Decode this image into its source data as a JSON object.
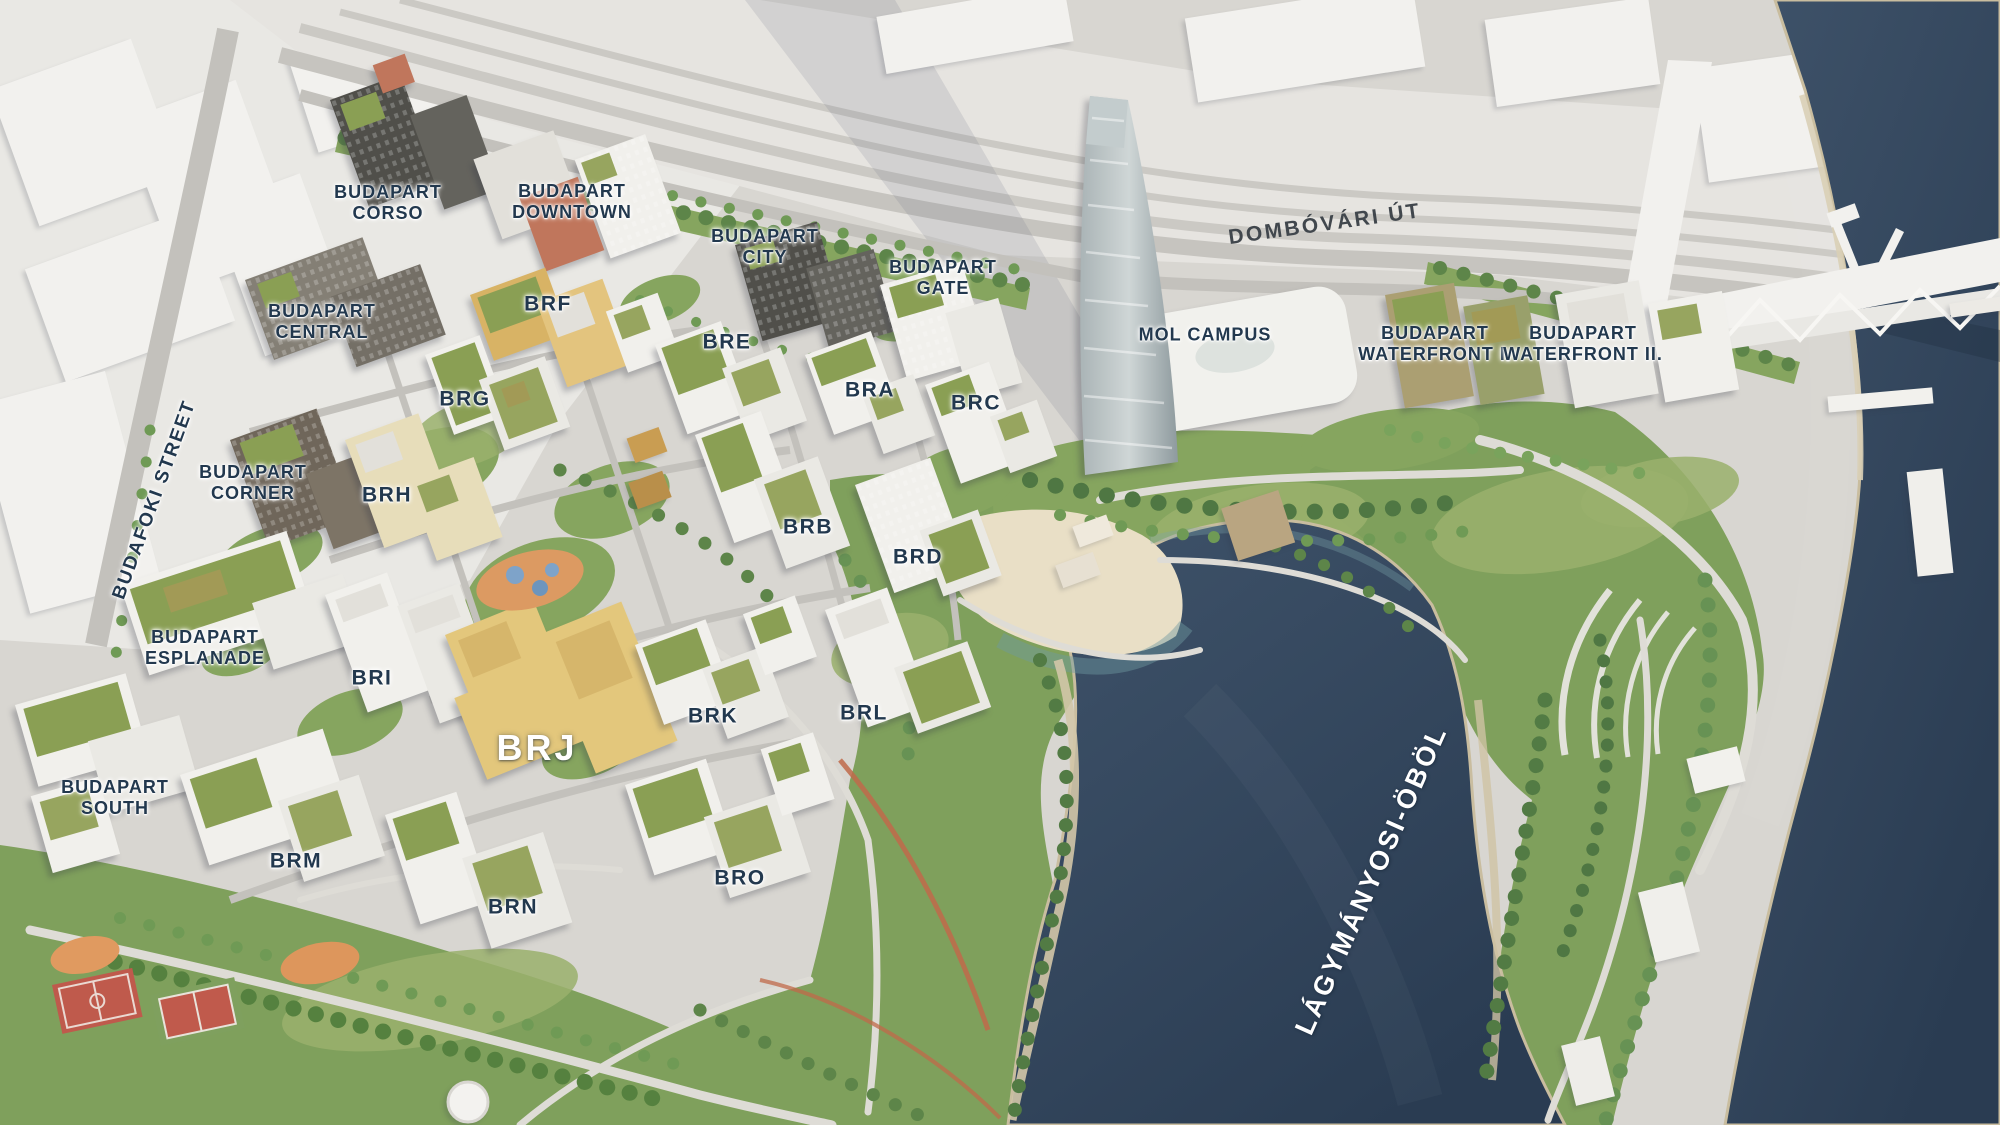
{
  "colors": {
    "water_light": "#3f536a",
    "water_dark": "#2a3c52",
    "highlight": "#e3c77c",
    "highlight_dark": "#d2b266",
    "park_green": "#7fa05c",
    "label_navy": "#22384e",
    "label_white": "#ffffff"
  },
  "highlighted_building": "BRJ",
  "labels": {
    "corso": {
      "text": "BUDAPART\nCORSO"
    },
    "downtown": {
      "text": "BUDAPART\nDOWNTOWN"
    },
    "city": {
      "text": "BUDAPART\nCITY"
    },
    "gate": {
      "text": "BUDAPART\nGATE"
    },
    "central": {
      "text": "BUDAPART\nCENTRAL"
    },
    "corner": {
      "text": "BUDAPART\nCORNER"
    },
    "esplanade": {
      "text": "BUDAPART\nESPLANADE"
    },
    "south": {
      "text": "BUDAPART\nSOUTH"
    },
    "waterfront1": {
      "text": "BUDAPART\nWATERFRONT I."
    },
    "waterfront2": {
      "text": "BUDAPART\nWATERFRONT II."
    },
    "mol": {
      "text": "MOL CAMPUS"
    },
    "dombovari": {
      "text": "DOMBÓVÁRI ÚT"
    },
    "budafoki": {
      "text": "BUDAFOKI STREET"
    },
    "bay": {
      "text": "LÁGYMÁNYOSI-ÖBÖL"
    },
    "bra": {
      "text": "BRA"
    },
    "brb": {
      "text": "BRB"
    },
    "brc": {
      "text": "BRC"
    },
    "brd": {
      "text": "BRD"
    },
    "bre": {
      "text": "BRE"
    },
    "brf": {
      "text": "BRF"
    },
    "brg": {
      "text": "BRG"
    },
    "brh": {
      "text": "BRH"
    },
    "bri": {
      "text": "BRI"
    },
    "brj": {
      "text": "BRJ"
    },
    "brk": {
      "text": "BRK"
    },
    "brl": {
      "text": "BRL"
    },
    "brm": {
      "text": "BRM"
    },
    "brn": {
      "text": "BRN"
    },
    "bro": {
      "text": "BRO"
    }
  }
}
